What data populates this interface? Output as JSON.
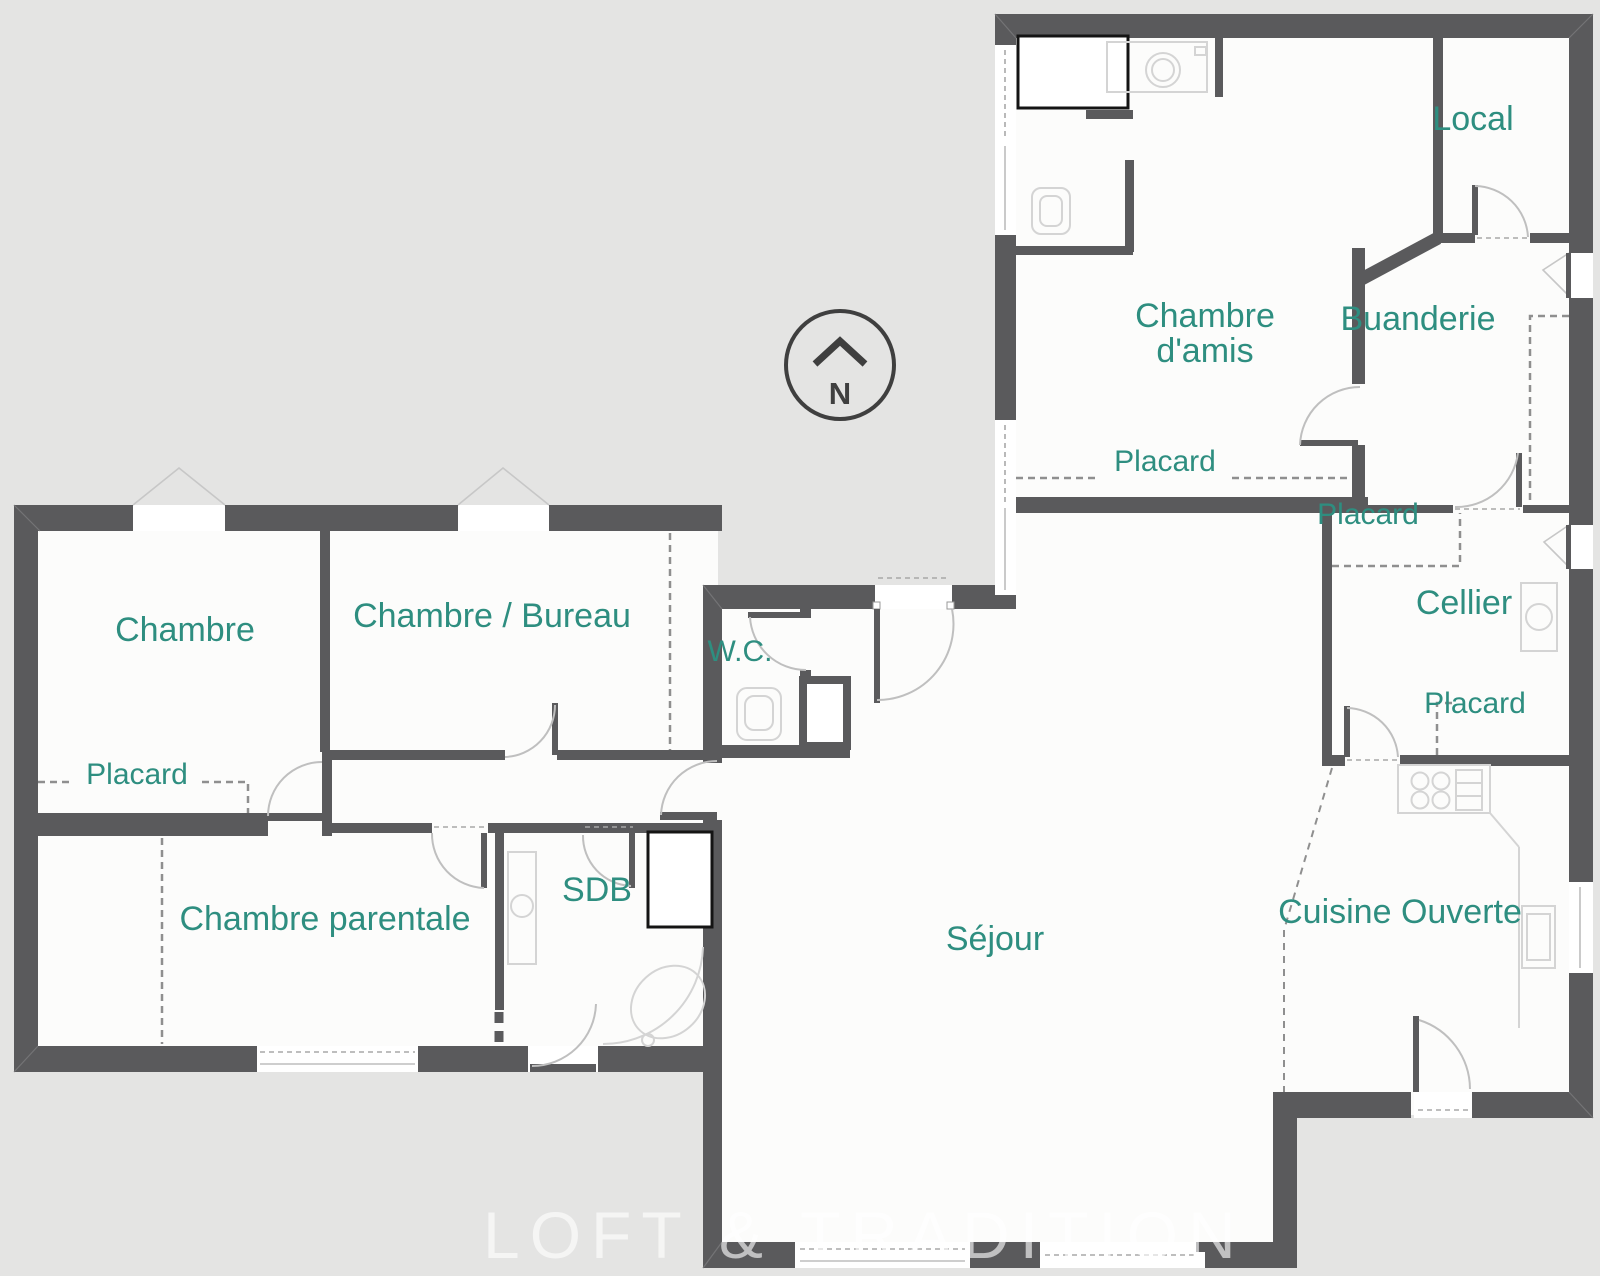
{
  "plan": {
    "labels": {
      "chambre": "Chambre",
      "chambre_bureau": "Chambre / Bureau",
      "wc": "W.C.",
      "placard_chambre": "Placard",
      "chambre_parentale": "Chambre parentale",
      "sdb": "SDB",
      "sejour": "Séjour",
      "cuisine": "Cuisine Ouverte",
      "chambre_damis_line1": "Chambre",
      "chambre_damis_line2": "d'amis",
      "placard_damis": "Placard",
      "buanderie": "Buanderie",
      "local": "Local",
      "cellier": "Cellier",
      "placard_cellier_haut": "Placard",
      "placard_cellier_bas": "Placard"
    },
    "compass": {
      "letter": "N"
    },
    "watermark": "LOFT & TRADITION",
    "colors": {
      "wall": "#5a5a5c",
      "label": "#2e8e80",
      "outside": "#e4e4e3",
      "room": "#fcfcfb",
      "fixture": "#d4d4d4",
      "arc": "#bfbfbf",
      "dash": "#8f8f8f",
      "dark": "#141414",
      "compass": "#3f3f3f"
    }
  }
}
